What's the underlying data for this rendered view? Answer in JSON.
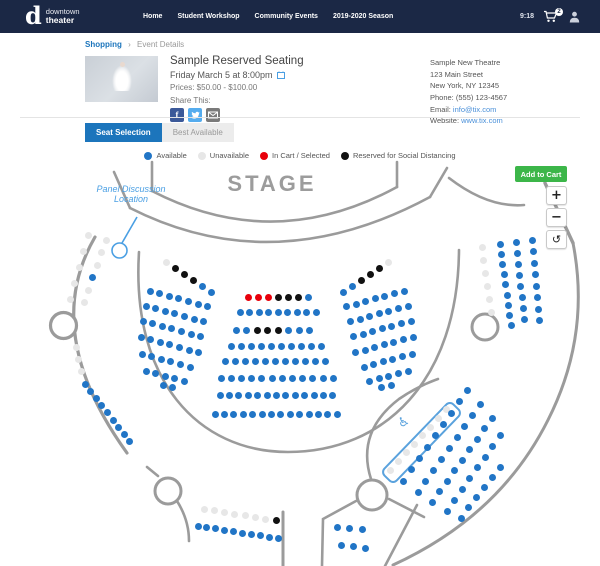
{
  "topbar": {
    "brand_mono": "d",
    "brand_line1": "downtown",
    "brand_line2": "theater",
    "nav": [
      "Home",
      "Student Workshop",
      "Community Events",
      "2019-2020 Season"
    ],
    "time": "9:18",
    "cart_count": "2"
  },
  "breadcrumb": {
    "shopping": "Shopping",
    "separator": "›",
    "current": "Event Details"
  },
  "event": {
    "title": "Sample Reserved Seating",
    "datetime": "Friday March 5 at 8:00pm",
    "prices": "Prices: $50.00 - $100.00",
    "share_label": "Share This:",
    "facebook_glyph": "f"
  },
  "venue": {
    "name": "Sample New Theatre",
    "address1": "123 Main Street",
    "address2": "New York, NY 12345",
    "phone": "Phone: (555) 123-4567",
    "email_label": "Email: ",
    "email": "info@tix.com",
    "website_label": "Website: ",
    "website": "www.tix.com"
  },
  "tabs": [
    {
      "label": "Seat Selection",
      "active": true
    },
    {
      "label": "Best Available",
      "active": false
    }
  ],
  "legend": [
    {
      "label": "Available",
      "color": "#2175c6"
    },
    {
      "label": "Unavailable",
      "color": "#e7e7e7"
    },
    {
      "label": "In Cart / Selected",
      "color": "#e8000b"
    },
    {
      "label": "Reserved for Social Distancing",
      "color": "#111111"
    }
  ],
  "map": {
    "stage_label": "STAGE",
    "annotation": "Panel Discussion Location",
    "add_to_cart_label": "Add to Cart",
    "zoom_in_label": "+",
    "zoom_out_label": "−",
    "reset_label": "↺",
    "wheelchair_glyph": "♿",
    "seat_colors": {
      "A": "#2175c6",
      "U": "#e7e7e7",
      "C": "#e8000b",
      "R": "#111111"
    },
    "rows": [
      {
        "x": 248,
        "y": 297,
        "dx": 10,
        "dy": 0,
        "s": "CCCRRRA"
      },
      {
        "x": 240,
        "y": 312,
        "dx": 9.5,
        "dy": 0,
        "s": "AAAAAAAAA"
      },
      {
        "x": 236,
        "y": 330,
        "dx": 10.5,
        "dy": 0,
        "s": "AARRRAAA"
      },
      {
        "x": 231,
        "y": 346,
        "dx": 10,
        "dy": 0,
        "s": "AAAAAAAAAA"
      },
      {
        "x": 225,
        "y": 361,
        "dx": 10,
        "dy": 0,
        "s": "AAAAAAAAAAA"
      },
      {
        "x": 221,
        "y": 378,
        "dx": 10.2,
        "dy": 0,
        "s": "AAAAAAAAAAAA"
      },
      {
        "x": 220,
        "y": 395,
        "dx": 9.4,
        "dy": 0,
        "s": "AAAAAAAAAAAAA"
      },
      {
        "x": 215,
        "y": 414,
        "dx": 9.4,
        "dy": 0,
        "s": "AAAAAAAAAAAAAA"
      },
      {
        "x": 166,
        "y": 262,
        "dx": 9,
        "dy": 6,
        "s": "URRRAA"
      },
      {
        "x": 150,
        "y": 291,
        "dx": 9.6,
        "dy": 2.6,
        "s": "AAAAAAA"
      },
      {
        "x": 146,
        "y": 306,
        "dx": 9.6,
        "dy": 2.6,
        "s": "AAAAAAA"
      },
      {
        "x": 143,
        "y": 321,
        "dx": 9.6,
        "dy": 2.6,
        "s": "AAAAAAA"
      },
      {
        "x": 141,
        "y": 337,
        "dx": 9.6,
        "dy": 2.6,
        "s": "AAAAAAA"
      },
      {
        "x": 142,
        "y": 354,
        "dx": 9.6,
        "dy": 2.6,
        "s": "AAAAAA"
      },
      {
        "x": 146,
        "y": 371,
        "dx": 9.6,
        "dy": 2.6,
        "s": "AAAAA"
      },
      {
        "x": 163,
        "y": 385,
        "dx": 9.6,
        "dy": 2.6,
        "s": "AA"
      },
      {
        "x": 388,
        "y": 262,
        "dx": -9,
        "dy": 6,
        "s": "URRRAA"
      },
      {
        "x": 404,
        "y": 291,
        "dx": -9.6,
        "dy": 2.6,
        "s": "AAAAAAA"
      },
      {
        "x": 408,
        "y": 306,
        "dx": -9.6,
        "dy": 2.6,
        "s": "AAAAAAA"
      },
      {
        "x": 411,
        "y": 321,
        "dx": -9.6,
        "dy": 2.6,
        "s": "AAAAAAA"
      },
      {
        "x": 413,
        "y": 337,
        "dx": -9.6,
        "dy": 2.6,
        "s": "AAAAAAA"
      },
      {
        "x": 412,
        "y": 354,
        "dx": -9.6,
        "dy": 2.6,
        "s": "AAAAAA"
      },
      {
        "x": 408,
        "y": 371,
        "dx": -9.6,
        "dy": 2.6,
        "s": "AAAAA"
      },
      {
        "x": 391,
        "y": 385,
        "dx": -9.6,
        "dy": 2.6,
        "s": "AA"
      },
      {
        "x": 88,
        "y": 235,
        "dx": -4.4,
        "dy": 16,
        "s": "UUUUU"
      },
      {
        "x": 106,
        "y": 240,
        "dx": -4.4,
        "dy": 12.5,
        "s": "UUUAUU"
      },
      {
        "x": 76,
        "y": 347,
        "dx": 2.5,
        "dy": 12,
        "s": "UUU"
      },
      {
        "x": 85,
        "y": 384,
        "dx": 5.6,
        "dy": 7.2,
        "s": "AAAAAAAAA"
      },
      {
        "x": 482,
        "y": 247,
        "dx": 1.8,
        "dy": 13,
        "s": "UUUUUU"
      },
      {
        "x": 500,
        "y": 244,
        "dx": 1.4,
        "dy": 10.2,
        "s": "AAAAAAAAA"
      },
      {
        "x": 516,
        "y": 242,
        "dx": 1.2,
        "dy": 11,
        "s": "AAAAAAAA"
      },
      {
        "x": 532,
        "y": 240,
        "dx": 1,
        "dy": 11.5,
        "s": "AAAAAAAA"
      },
      {
        "x": 390,
        "y": 470,
        "dx": 8,
        "dy": -8.6,
        "s": "UUUUUUUU"
      },
      {
        "x": 403,
        "y": 481,
        "dx": 8,
        "dy": -11.3,
        "s": "AAAAAAAAA"
      },
      {
        "x": 418,
        "y": 492,
        "dx": 7.8,
        "dy": -10.9,
        "s": "AAAAAAAAA"
      },
      {
        "x": 432,
        "y": 502,
        "dx": 7.5,
        "dy": -10.5,
        "s": "AAAAAAAAA"
      },
      {
        "x": 447,
        "y": 511,
        "dx": 7.6,
        "dy": -10.8,
        "s": "AAAAAAAA"
      },
      {
        "x": 461,
        "y": 518,
        "dx": 7.8,
        "dy": -10.2,
        "s": "AAAAAA"
      },
      {
        "x": 204,
        "y": 509,
        "dx": 10.3,
        "dy": 1.7,
        "s": "UUUUUUUR"
      },
      {
        "x": 198,
        "y": 526,
        "dx": 8.9,
        "dy": 1.4,
        "s": "AAAAAAAAAA"
      },
      {
        "x": 337,
        "y": 527,
        "dx": 12.5,
        "dy": 1,
        "s": "AAA"
      },
      {
        "x": 341,
        "y": 545,
        "dx": 12,
        "dy": 1.5,
        "s": "AAA"
      }
    ]
  }
}
